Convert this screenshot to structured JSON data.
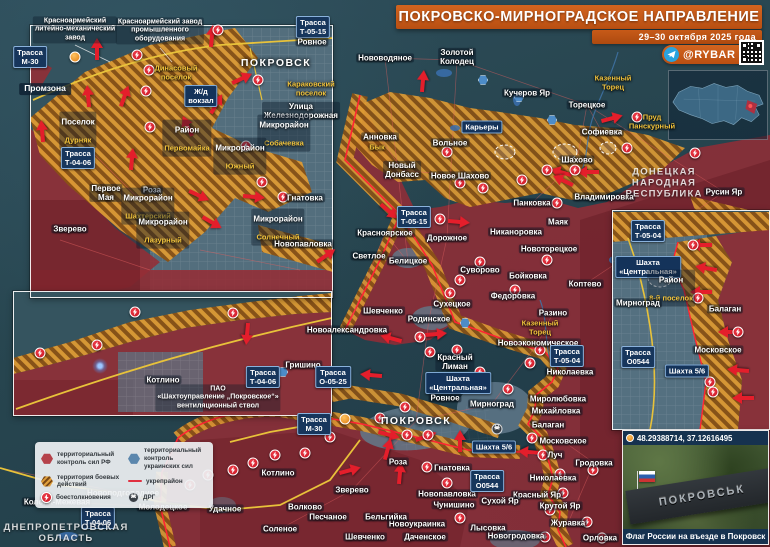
{
  "banner": {
    "title": "ПОКРОВСКО-МИРНОГРАДСКОЕ НАПРАВЛЕНИЕ",
    "subtitle": "29–30 октября 2025 года",
    "brand": "@RYBAR"
  },
  "photo_inset": {
    "coords": "48.29388714, 37.12616495",
    "caption": "Флаг России на въезде в Покровск",
    "sign_text": "ПОКРОВСЬК"
  },
  "legend": {
    "items": [
      {
        "icon": "hexred",
        "label": "территориальный контроль сил РФ"
      },
      {
        "icon": "hexblue",
        "label": "территориальный контроль украинских сил"
      },
      {
        "icon": "hatch",
        "label": "территория боевых действий"
      },
      {
        "icon": "lred",
        "label": "укрепрайон"
      },
      {
        "icon": "clash",
        "label": "боестолкновения"
      },
      {
        "icon": "drgi",
        "label": "ДРГ"
      }
    ]
  },
  "colors": {
    "accent_orange": "#c65a17",
    "rf_red": "#942d36",
    "ua_teal": "#2c4a57",
    "combat_orange": "#dd9a33",
    "road_badge_blue": "#17365c",
    "clash_red": "#d31f2e",
    "highway_yellow": "#e8c23a"
  },
  "map_labels": [
    {
      "text": "Нововодяное",
      "x": 385,
      "y": 58,
      "type": "town"
    },
    {
      "text": "Золотой\nКолодец",
      "x": 457,
      "y": 57,
      "type": "town"
    },
    {
      "text": "Кучеров Яр",
      "x": 527,
      "y": 93,
      "type": "town"
    },
    {
      "text": "Карьеры",
      "x": 482,
      "y": 127,
      "type": "badge"
    },
    {
      "text": "Анновка",
      "x": 380,
      "y": 137,
      "type": "town"
    },
    {
      "text": "Бык",
      "x": 377,
      "y": 148,
      "type": "water"
    },
    {
      "text": "Вольное",
      "x": 450,
      "y": 143,
      "type": "town"
    },
    {
      "text": "Новый\nДонбасс",
      "x": 402,
      "y": 170,
      "type": "town"
    },
    {
      "text": "Новое Шахово",
      "x": 460,
      "y": 176,
      "type": "town"
    },
    {
      "text": "Торецкое",
      "x": 587,
      "y": 105,
      "type": "town"
    },
    {
      "text": "Казенный\nТорец",
      "x": 613,
      "y": 83,
      "type": "water"
    },
    {
      "text": "Софиевка",
      "x": 602,
      "y": 132,
      "type": "town"
    },
    {
      "text": "Пруд\nПанскурный",
      "x": 652,
      "y": 122,
      "type": "water"
    },
    {
      "text": "Шахово",
      "x": 577,
      "y": 160,
      "type": "town"
    },
    {
      "text": "Владимировка",
      "x": 604,
      "y": 197,
      "type": "town"
    },
    {
      "text": "Русин Яр",
      "x": 724,
      "y": 192,
      "type": "town"
    },
    {
      "text": "ДОНЕЦКАЯ\nНАРОДНАЯ\nРЕСПУБЛИКА",
      "x": 664,
      "y": 184,
      "type": "region"
    },
    {
      "text": "Красноярское",
      "x": 385,
      "y": 233,
      "type": "town"
    },
    {
      "text": "Светлое",
      "x": 369,
      "y": 256,
      "type": "town"
    },
    {
      "text": "Белицкое",
      "x": 408,
      "y": 261,
      "type": "town"
    },
    {
      "text": "Дорожное",
      "x": 447,
      "y": 238,
      "type": "town"
    },
    {
      "text": "Никаноровка",
      "x": 516,
      "y": 232,
      "type": "town"
    },
    {
      "text": "Панковка",
      "x": 532,
      "y": 203,
      "type": "town"
    },
    {
      "text": "Маяк",
      "x": 558,
      "y": 222,
      "type": "town"
    },
    {
      "text": "Новоторецкое",
      "x": 549,
      "y": 249,
      "type": "town"
    },
    {
      "text": "Суворово",
      "x": 480,
      "y": 270,
      "type": "town"
    },
    {
      "text": "Бойковка",
      "x": 528,
      "y": 276,
      "type": "town"
    },
    {
      "text": "Федоровка",
      "x": 513,
      "y": 296,
      "type": "town"
    },
    {
      "text": "Сухецкое",
      "x": 452,
      "y": 304,
      "type": "town"
    },
    {
      "text": "Коптево",
      "x": 585,
      "y": 284,
      "type": "town"
    },
    {
      "text": "Шевченко",
      "x": 383,
      "y": 311,
      "type": "town"
    },
    {
      "text": "Разино",
      "x": 553,
      "y": 313,
      "type": "town"
    },
    {
      "text": "Родинское",
      "x": 429,
      "y": 319,
      "type": "town"
    },
    {
      "text": "Казенный\nТорец",
      "x": 540,
      "y": 328,
      "type": "water"
    },
    {
      "text": "Новоэкономическое",
      "x": 538,
      "y": 343,
      "type": "town"
    },
    {
      "text": "Красный\nЛиман",
      "x": 455,
      "y": 362,
      "type": "town"
    },
    {
      "text": "Николаевка",
      "x": 570,
      "y": 372,
      "type": "town"
    },
    {
      "text": "Гришино",
      "x": 303,
      "y": 365,
      "type": "town"
    },
    {
      "text": "Трасса\nТ-05-15",
      "x": 414,
      "y": 217,
      "type": "road"
    },
    {
      "text": "Трасса\nТ-05-04",
      "x": 567,
      "y": 356,
      "type": "road"
    },
    {
      "text": "Трасса\nО-05-25",
      "x": 333,
      "y": 377,
      "type": "road"
    },
    {
      "text": "Новоалександровка",
      "x": 347,
      "y": 330,
      "type": "town"
    },
    {
      "text": "Шахта\n«Центральная»",
      "x": 458,
      "y": 383,
      "type": "badge"
    },
    {
      "text": "Ровное",
      "x": 445,
      "y": 398,
      "type": "town"
    },
    {
      "text": "Мирноград",
      "x": 492,
      "y": 404,
      "type": "town"
    },
    {
      "text": "ПОКРОВСК",
      "x": 416,
      "y": 421,
      "type": "city"
    },
    {
      "text": "Миролюбовка",
      "x": 558,
      "y": 399,
      "type": "town"
    },
    {
      "text": "Михайловка",
      "x": 556,
      "y": 411,
      "type": "town"
    },
    {
      "text": "Балаган",
      "x": 548,
      "y": 425,
      "type": "town"
    },
    {
      "text": "Московское",
      "x": 563,
      "y": 441,
      "type": "town"
    },
    {
      "text": "Луч",
      "x": 555,
      "y": 455,
      "type": "town"
    },
    {
      "text": "Гродовка",
      "x": 594,
      "y": 463,
      "type": "town"
    },
    {
      "text": "Николаевка",
      "x": 553,
      "y": 478,
      "type": "town"
    },
    {
      "text": "Красный Яр",
      "x": 537,
      "y": 495,
      "type": "town"
    },
    {
      "text": "Крутой Яр",
      "x": 560,
      "y": 506,
      "type": "town"
    },
    {
      "text": "Журавка",
      "x": 568,
      "y": 523,
      "type": "town"
    },
    {
      "text": "Новогродовка",
      "x": 516,
      "y": 536,
      "type": "town"
    },
    {
      "text": "Орловка",
      "x": 600,
      "y": 538,
      "type": "town"
    },
    {
      "text": "Лысовка",
      "x": 488,
      "y": 528,
      "type": "town"
    },
    {
      "text": "Даченское",
      "x": 425,
      "y": 537,
      "type": "town"
    },
    {
      "text": "Шевченко",
      "x": 365,
      "y": 537,
      "type": "town"
    },
    {
      "text": "Новоукраинка",
      "x": 417,
      "y": 524,
      "type": "town"
    },
    {
      "text": "Бельгийка",
      "x": 386,
      "y": 517,
      "type": "town"
    },
    {
      "text": "Чунишино",
      "x": 454,
      "y": 505,
      "type": "town"
    },
    {
      "text": "Сухой Яр",
      "x": 500,
      "y": 501,
      "type": "town"
    },
    {
      "text": "Новопавловка",
      "x": 447,
      "y": 494,
      "type": "town"
    },
    {
      "text": "Гнатовка",
      "x": 452,
      "y": 468,
      "type": "town"
    },
    {
      "text": "Роза",
      "x": 398,
      "y": 462,
      "type": "town"
    },
    {
      "text": "Зверево",
      "x": 352,
      "y": 490,
      "type": "town"
    },
    {
      "text": "Волково",
      "x": 305,
      "y": 507,
      "type": "town"
    },
    {
      "text": "Песчаное",
      "x": 328,
      "y": 517,
      "type": "town"
    },
    {
      "text": "Соленое",
      "x": 280,
      "y": 529,
      "type": "town"
    },
    {
      "text": "Удачное",
      "x": 225,
      "y": 509,
      "type": "town"
    },
    {
      "text": "Котлино",
      "x": 278,
      "y": 473,
      "type": "town"
    },
    {
      "text": "Молодецкое",
      "x": 163,
      "y": 507,
      "type": "town"
    },
    {
      "text": "Новоподгородное",
      "x": 123,
      "y": 493,
      "type": "town"
    },
    {
      "text": "Колона-Межевая",
      "x": 57,
      "y": 502,
      "type": "town"
    },
    {
      "text": "Трасса\nТ-04-06",
      "x": 98,
      "y": 518,
      "type": "road"
    },
    {
      "text": "ДНЕПРОПЕТРОВСКАЯ\nОБЛАСТЬ",
      "x": 66,
      "y": 534,
      "type": "region"
    },
    {
      "text": "Трасса\nМ-30",
      "x": 314,
      "y": 424,
      "type": "road"
    },
    {
      "text": "Шахта 5/6",
      "x": 494,
      "y": 447,
      "type": "badge"
    },
    {
      "text": "Трасса\nО0544",
      "x": 487,
      "y": 481,
      "type": "road"
    },
    {
      "text": "Красноармейский\nлитейно-механический\nзавод",
      "x": 75,
      "y": 30,
      "type": "plant"
    },
    {
      "text": "Красноармейский завод\nпромышленного\nоборудования",
      "x": 160,
      "y": 31,
      "type": "plant"
    },
    {
      "text": "Трасса\nМ-30",
      "x": 30,
      "y": 57,
      "type": "road"
    },
    {
      "text": "Промзона",
      "x": 45,
      "y": 89,
      "type": "area"
    },
    {
      "text": "Динасовый\nпоселок",
      "x": 176,
      "y": 73,
      "type": "water"
    },
    {
      "text": "Поселок",
      "text2": "Дурняк",
      "x": 78,
      "y": 130,
      "type": "district"
    },
    {
      "text": "Ж/д\nвокзал",
      "x": 201,
      "y": 96,
      "type": "badge"
    },
    {
      "text": "ПОКРОВСК",
      "x": 276,
      "y": 63,
      "type": "city"
    },
    {
      "text": "Трасса\nТ-05-15",
      "x": 313,
      "y": 27,
      "type": "road"
    },
    {
      "text": "Ровное",
      "x": 312,
      "y": 42,
      "type": "town"
    },
    {
      "text": "Караковский\nпоселок",
      "x": 311,
      "y": 89,
      "type": "water"
    },
    {
      "text": "Улица\nЖелезнодорожная",
      "x": 301,
      "y": 111,
      "type": "town"
    },
    {
      "text": "Микрорайон",
      "text2": "Собачевка",
      "x": 284,
      "y": 133,
      "type": "district"
    },
    {
      "text": "Район",
      "text2": "Первомайка",
      "x": 187,
      "y": 138,
      "type": "district"
    },
    {
      "text": "Микрорайон",
      "text2": "Южный",
      "x": 240,
      "y": 156,
      "type": "district"
    },
    {
      "text": "Трасса\nТ-04-06",
      "x": 78,
      "y": 158,
      "type": "road"
    },
    {
      "text": "Первое\nМая",
      "x": 106,
      "y": 193,
      "type": "town"
    },
    {
      "text": "Роза",
      "x": 152,
      "y": 190,
      "type": "town"
    },
    {
      "text": "Микрорайон",
      "text2": "Шахтерский",
      "x": 148,
      "y": 206,
      "type": "district"
    },
    {
      "text": "Зверево",
      "x": 70,
      "y": 229,
      "type": "town"
    },
    {
      "text": "Микрорайон",
      "text2": "Лазурный",
      "x": 163,
      "y": 230,
      "type": "district"
    },
    {
      "text": "Микрорайон",
      "text2": "Солнечный",
      "x": 278,
      "y": 227,
      "type": "district"
    },
    {
      "text": "Гнатовка",
      "x": 305,
      "y": 198,
      "type": "town"
    },
    {
      "text": "Новопавловка",
      "x": 303,
      "y": 244,
      "type": "town"
    },
    {
      "text": "Котлино",
      "x": 163,
      "y": 380,
      "type": "town"
    },
    {
      "text": "ПАО\n«Шахтоуправление „Покровское“»\nвентиляционный ствол",
      "x": 218,
      "y": 398,
      "type": "plant"
    },
    {
      "text": "Трасса\nТ-04-06",
      "x": 263,
      "y": 377,
      "type": "road"
    },
    {
      "text": "Трасса\nТ-05-04",
      "x": 648,
      "y": 231,
      "type": "road"
    },
    {
      "text": "Шахта\n«Центральная»",
      "x": 648,
      "y": 267,
      "type": "badge"
    },
    {
      "text": "Район",
      "text2": "8-й поселок",
      "x": 671,
      "y": 288,
      "type": "district"
    },
    {
      "text": "Мирноград",
      "x": 638,
      "y": 303,
      "type": "town"
    },
    {
      "text": "Балаган",
      "x": 725,
      "y": 309,
      "type": "town"
    },
    {
      "text": "Московское",
      "x": 718,
      "y": 350,
      "type": "town"
    },
    {
      "text": "Трасса\nО0544",
      "x": 638,
      "y": 357,
      "type": "road"
    },
    {
      "text": "Шахта 5/6",
      "x": 687,
      "y": 371,
      "type": "badge"
    }
  ],
  "icons": [
    {
      "t": "clash",
      "x": 137,
      "y": 55
    },
    {
      "t": "clash",
      "x": 149,
      "y": 70
    },
    {
      "t": "clash",
      "x": 146,
      "y": 91
    },
    {
      "t": "clash",
      "x": 28,
      "y": 53
    },
    {
      "t": "clash",
      "x": 218,
      "y": 30
    },
    {
      "t": "clash",
      "x": 258,
      "y": 80
    },
    {
      "t": "clash",
      "x": 150,
      "y": 127
    },
    {
      "t": "clash",
      "x": 246,
      "y": 146
    },
    {
      "t": "clash",
      "x": 262,
      "y": 182
    },
    {
      "t": "clash",
      "x": 283,
      "y": 197
    },
    {
      "t": "clash",
      "x": 40,
      "y": 353
    },
    {
      "t": "clash",
      "x": 97,
      "y": 345
    },
    {
      "t": "clash",
      "x": 135,
      "y": 312
    },
    {
      "t": "clash",
      "x": 233,
      "y": 313
    },
    {
      "t": "clash",
      "x": 693,
      "y": 245
    },
    {
      "t": "clash",
      "x": 698,
      "y": 298
    },
    {
      "t": "clash",
      "x": 710,
      "y": 382
    },
    {
      "t": "clash",
      "x": 713,
      "y": 392
    },
    {
      "t": "clash",
      "x": 738,
      "y": 332
    },
    {
      "t": "clash",
      "x": 447,
      "y": 152
    },
    {
      "t": "clash",
      "x": 460,
      "y": 183
    },
    {
      "t": "clash",
      "x": 522,
      "y": 180
    },
    {
      "t": "clash",
      "x": 547,
      "y": 170
    },
    {
      "t": "clash",
      "x": 637,
      "y": 117
    },
    {
      "t": "clash",
      "x": 575,
      "y": 170
    },
    {
      "t": "clash",
      "x": 627,
      "y": 148
    },
    {
      "t": "clash",
      "x": 695,
      "y": 153
    },
    {
      "t": "clash",
      "x": 440,
      "y": 219
    },
    {
      "t": "clash",
      "x": 483,
      "y": 188
    },
    {
      "t": "clash",
      "x": 480,
      "y": 262
    },
    {
      "t": "clash",
      "x": 460,
      "y": 280
    },
    {
      "t": "clash",
      "x": 450,
      "y": 293
    },
    {
      "t": "clash",
      "x": 515,
      "y": 290
    },
    {
      "t": "clash",
      "x": 547,
      "y": 260
    },
    {
      "t": "clash",
      "x": 557,
      "y": 203
    },
    {
      "t": "clash",
      "x": 420,
      "y": 337
    },
    {
      "t": "clash",
      "x": 430,
      "y": 352
    },
    {
      "t": "clash",
      "x": 457,
      "y": 350
    },
    {
      "t": "clash",
      "x": 480,
      "y": 372
    },
    {
      "t": "clash",
      "x": 508,
      "y": 389
    },
    {
      "t": "clash",
      "x": 530,
      "y": 363
    },
    {
      "t": "clash",
      "x": 540,
      "y": 350
    },
    {
      "t": "clash",
      "x": 380,
      "y": 418
    },
    {
      "t": "clash",
      "x": 405,
      "y": 407
    },
    {
      "t": "clash",
      "x": 330,
      "y": 437
    },
    {
      "t": "clash",
      "x": 407,
      "y": 435
    },
    {
      "t": "clash",
      "x": 428,
      "y": 435
    },
    {
      "t": "clash",
      "x": 427,
      "y": 467
    },
    {
      "t": "clash",
      "x": 447,
      "y": 483
    },
    {
      "t": "clash",
      "x": 460,
      "y": 518
    },
    {
      "t": "clash",
      "x": 305,
      "y": 453
    },
    {
      "t": "clash",
      "x": 532,
      "y": 438
    },
    {
      "t": "clash",
      "x": 543,
      "y": 455
    },
    {
      "t": "clash",
      "x": 593,
      "y": 470
    },
    {
      "t": "clash",
      "x": 560,
      "y": 474
    },
    {
      "t": "clash",
      "x": 563,
      "y": 493
    },
    {
      "t": "clash",
      "x": 550,
      "y": 510
    },
    {
      "t": "clash",
      "x": 587,
      "y": 522
    },
    {
      "t": "clash",
      "x": 602,
      "y": 538
    },
    {
      "t": "clash",
      "x": 545,
      "y": 537
    },
    {
      "t": "clash",
      "x": 275,
      "y": 455
    },
    {
      "t": "clash",
      "x": 253,
      "y": 463
    },
    {
      "t": "clash",
      "x": 233,
      "y": 470
    },
    {
      "t": "clash",
      "x": 208,
      "y": 475
    },
    {
      "t": "clash",
      "x": 190,
      "y": 485
    },
    {
      "t": "bluehex",
      "x": 483,
      "y": 80
    },
    {
      "t": "bluehex",
      "x": 519,
      "y": 97
    },
    {
      "t": "bluehex",
      "x": 552,
      "y": 120
    },
    {
      "t": "bluehex",
      "x": 465,
      "y": 323
    },
    {
      "t": "bluehex",
      "x": 283,
      "y": 372
    },
    {
      "t": "pin",
      "x": 75,
      "y": 57
    },
    {
      "t": "pin",
      "x": 345,
      "y": 419
    },
    {
      "t": "station",
      "x": 193,
      "y": 97
    },
    {
      "t": "drg",
      "x": 497,
      "y": 429
    },
    {
      "t": "glow",
      "x": 100,
      "y": 366
    }
  ],
  "arrows": [
    {
      "x": 97,
      "y": 48,
      "r": -90
    },
    {
      "x": 88,
      "y": 95,
      "r": -95
    },
    {
      "x": 125,
      "y": 95,
      "r": -70
    },
    {
      "x": 42,
      "y": 130,
      "r": -95
    },
    {
      "x": 212,
      "y": 35,
      "r": -85
    },
    {
      "x": 243,
      "y": 78,
      "r": -25
    },
    {
      "x": 217,
      "y": 103,
      "r": -60
    },
    {
      "x": 187,
      "y": 125,
      "r": -115
    },
    {
      "x": 132,
      "y": 158,
      "r": -85
    },
    {
      "x": 200,
      "y": 196,
      "r": 25
    },
    {
      "x": 213,
      "y": 223,
      "r": 30
    },
    {
      "x": 255,
      "y": 197,
      "r": 5
    },
    {
      "x": 327,
      "y": 255,
      "r": -35
    },
    {
      "x": 247,
      "y": 335,
      "r": 95
    },
    {
      "x": 613,
      "y": 118,
      "r": -15
    },
    {
      "x": 560,
      "y": 172,
      "r": 195
    },
    {
      "x": 587,
      "y": 172,
      "r": 180
    },
    {
      "x": 562,
      "y": 180,
      "r": 205
    },
    {
      "x": 423,
      "y": 80,
      "r": -85
    },
    {
      "x": 390,
      "y": 212,
      "r": 40
    },
    {
      "x": 460,
      "y": 222,
      "r": 5
    },
    {
      "x": 390,
      "y": 338,
      "r": 195
    },
    {
      "x": 370,
      "y": 375,
      "r": 185
    },
    {
      "x": 437,
      "y": 334,
      "r": -5
    },
    {
      "x": 390,
      "y": 435,
      "r": 15
    },
    {
      "x": 427,
      "y": 436,
      "r": -20
    },
    {
      "x": 388,
      "y": 448,
      "r": -75
    },
    {
      "x": 400,
      "y": 472,
      "r": -85
    },
    {
      "x": 351,
      "y": 470,
      "r": -15
    },
    {
      "x": 460,
      "y": 440,
      "r": -90
    },
    {
      "x": 700,
      "y": 245,
      "r": 180
    },
    {
      "x": 705,
      "y": 268,
      "r": 190
    },
    {
      "x": 700,
      "y": 292,
      "r": 180
    },
    {
      "x": 728,
      "y": 332,
      "r": 180
    },
    {
      "x": 737,
      "y": 370,
      "r": 185
    },
    {
      "x": 742,
      "y": 398,
      "r": 180
    },
    {
      "x": 528,
      "y": 452,
      "r": 185
    }
  ]
}
